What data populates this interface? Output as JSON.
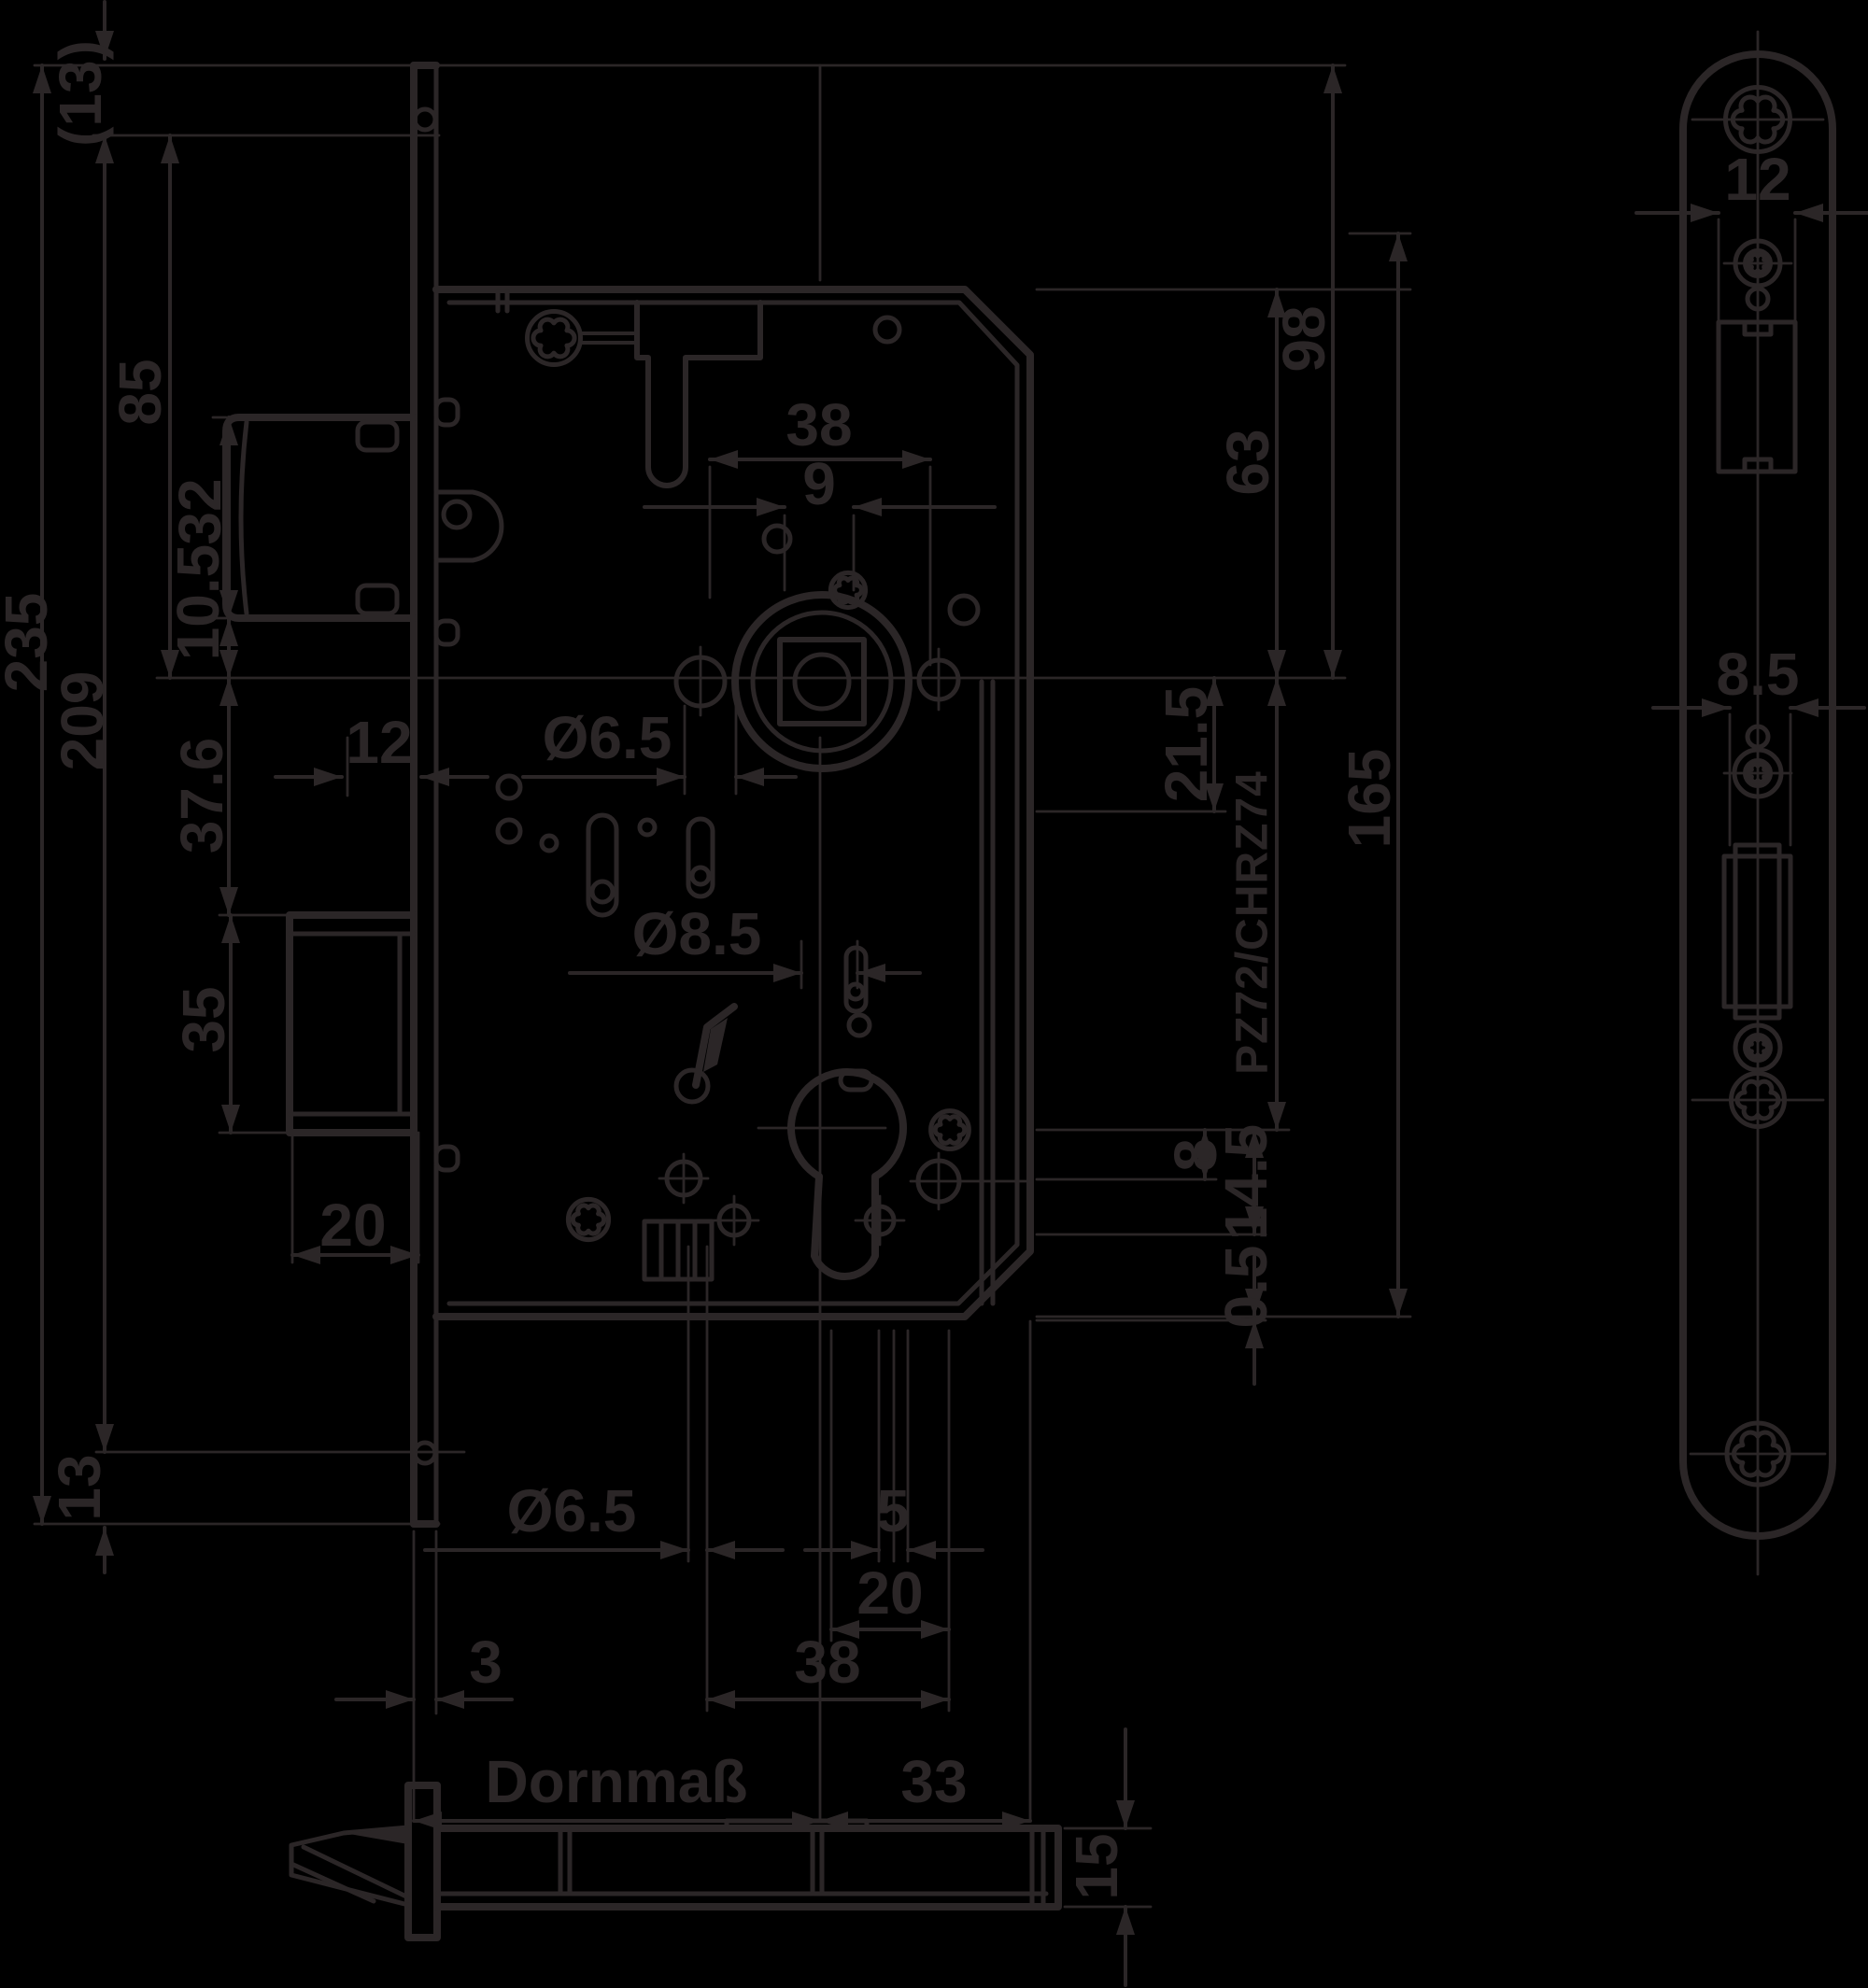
{
  "diagram": {
    "type": "technical-drawing",
    "background_color": "#000000",
    "line_color": "#2b2627",
    "labels": {
      "bracket13": "(13)",
      "n235": "235",
      "n209": "209",
      "n13": "13",
      "n85": "85",
      "n32": "32",
      "n10_5": "10.5",
      "n12_left": "12",
      "n37_6": "37.6",
      "n35": "35",
      "n20_bolt": "20",
      "dia6_5_upper": "Ø6.5",
      "dia8_5": "Ø8.5",
      "n38_upper": "38",
      "n9": "9",
      "n98": "98",
      "n63": "63",
      "n165": "165",
      "n21_5": "21.5",
      "cylinder_code": "PZ72/CHRZ74",
      "n8": "8",
      "n14_5": "14.5",
      "n0_5": "0.5",
      "dia6_5_lower": "Ø6.5",
      "n5": "5",
      "n20_lower": "20",
      "n38_lower": "38",
      "n3": "3",
      "dornmass": "Dornmaß",
      "n33": "33",
      "n12_plate": "12",
      "n8_5_plate": "8.5",
      "n15": "15"
    }
  }
}
